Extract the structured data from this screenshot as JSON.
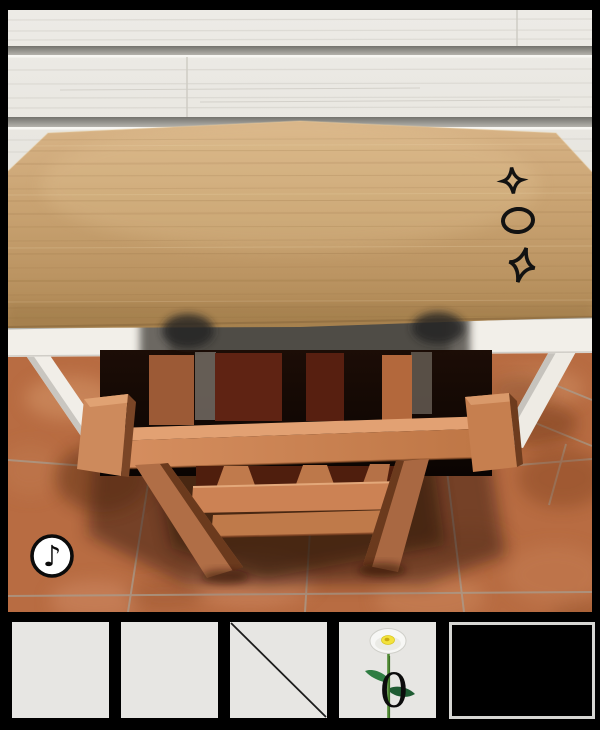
{
  "app": {
    "title": "Escape game - table and chair room view"
  },
  "scene": {
    "description": "3D room: wooden table against white plank wall, orange chair underneath, terracotta tile floor",
    "music_button": {
      "icon": "eighth-note-icon",
      "glyph": "♪"
    },
    "table_symbols": [
      {
        "name": "sparkle-four-point-star",
        "glyph": "✧"
      },
      {
        "name": "oval",
        "glyph": "○"
      },
      {
        "name": "sparkle-four-point-star",
        "glyph": "✧"
      }
    ]
  },
  "inventory": {
    "slots": [
      {
        "name": "slot-1",
        "item": "empty"
      },
      {
        "name": "slot-2",
        "item": "empty"
      },
      {
        "name": "slot-3",
        "item": "stick"
      },
      {
        "name": "slot-4",
        "item": "flower",
        "count": "0"
      },
      {
        "name": "item-view",
        "item": "empty"
      }
    ]
  },
  "colors": {
    "frame": "#000000",
    "wall": "#e9e7e1",
    "tabletop_wood": "#c49e6c",
    "table_white": "#f2efe9",
    "chair_orange": "#cd8557",
    "backrest_maroon": "#5f2313",
    "floor_terracotta": "#b86c42",
    "slot_gray": "#e7e6e3",
    "symbol_ink": "#111111"
  }
}
